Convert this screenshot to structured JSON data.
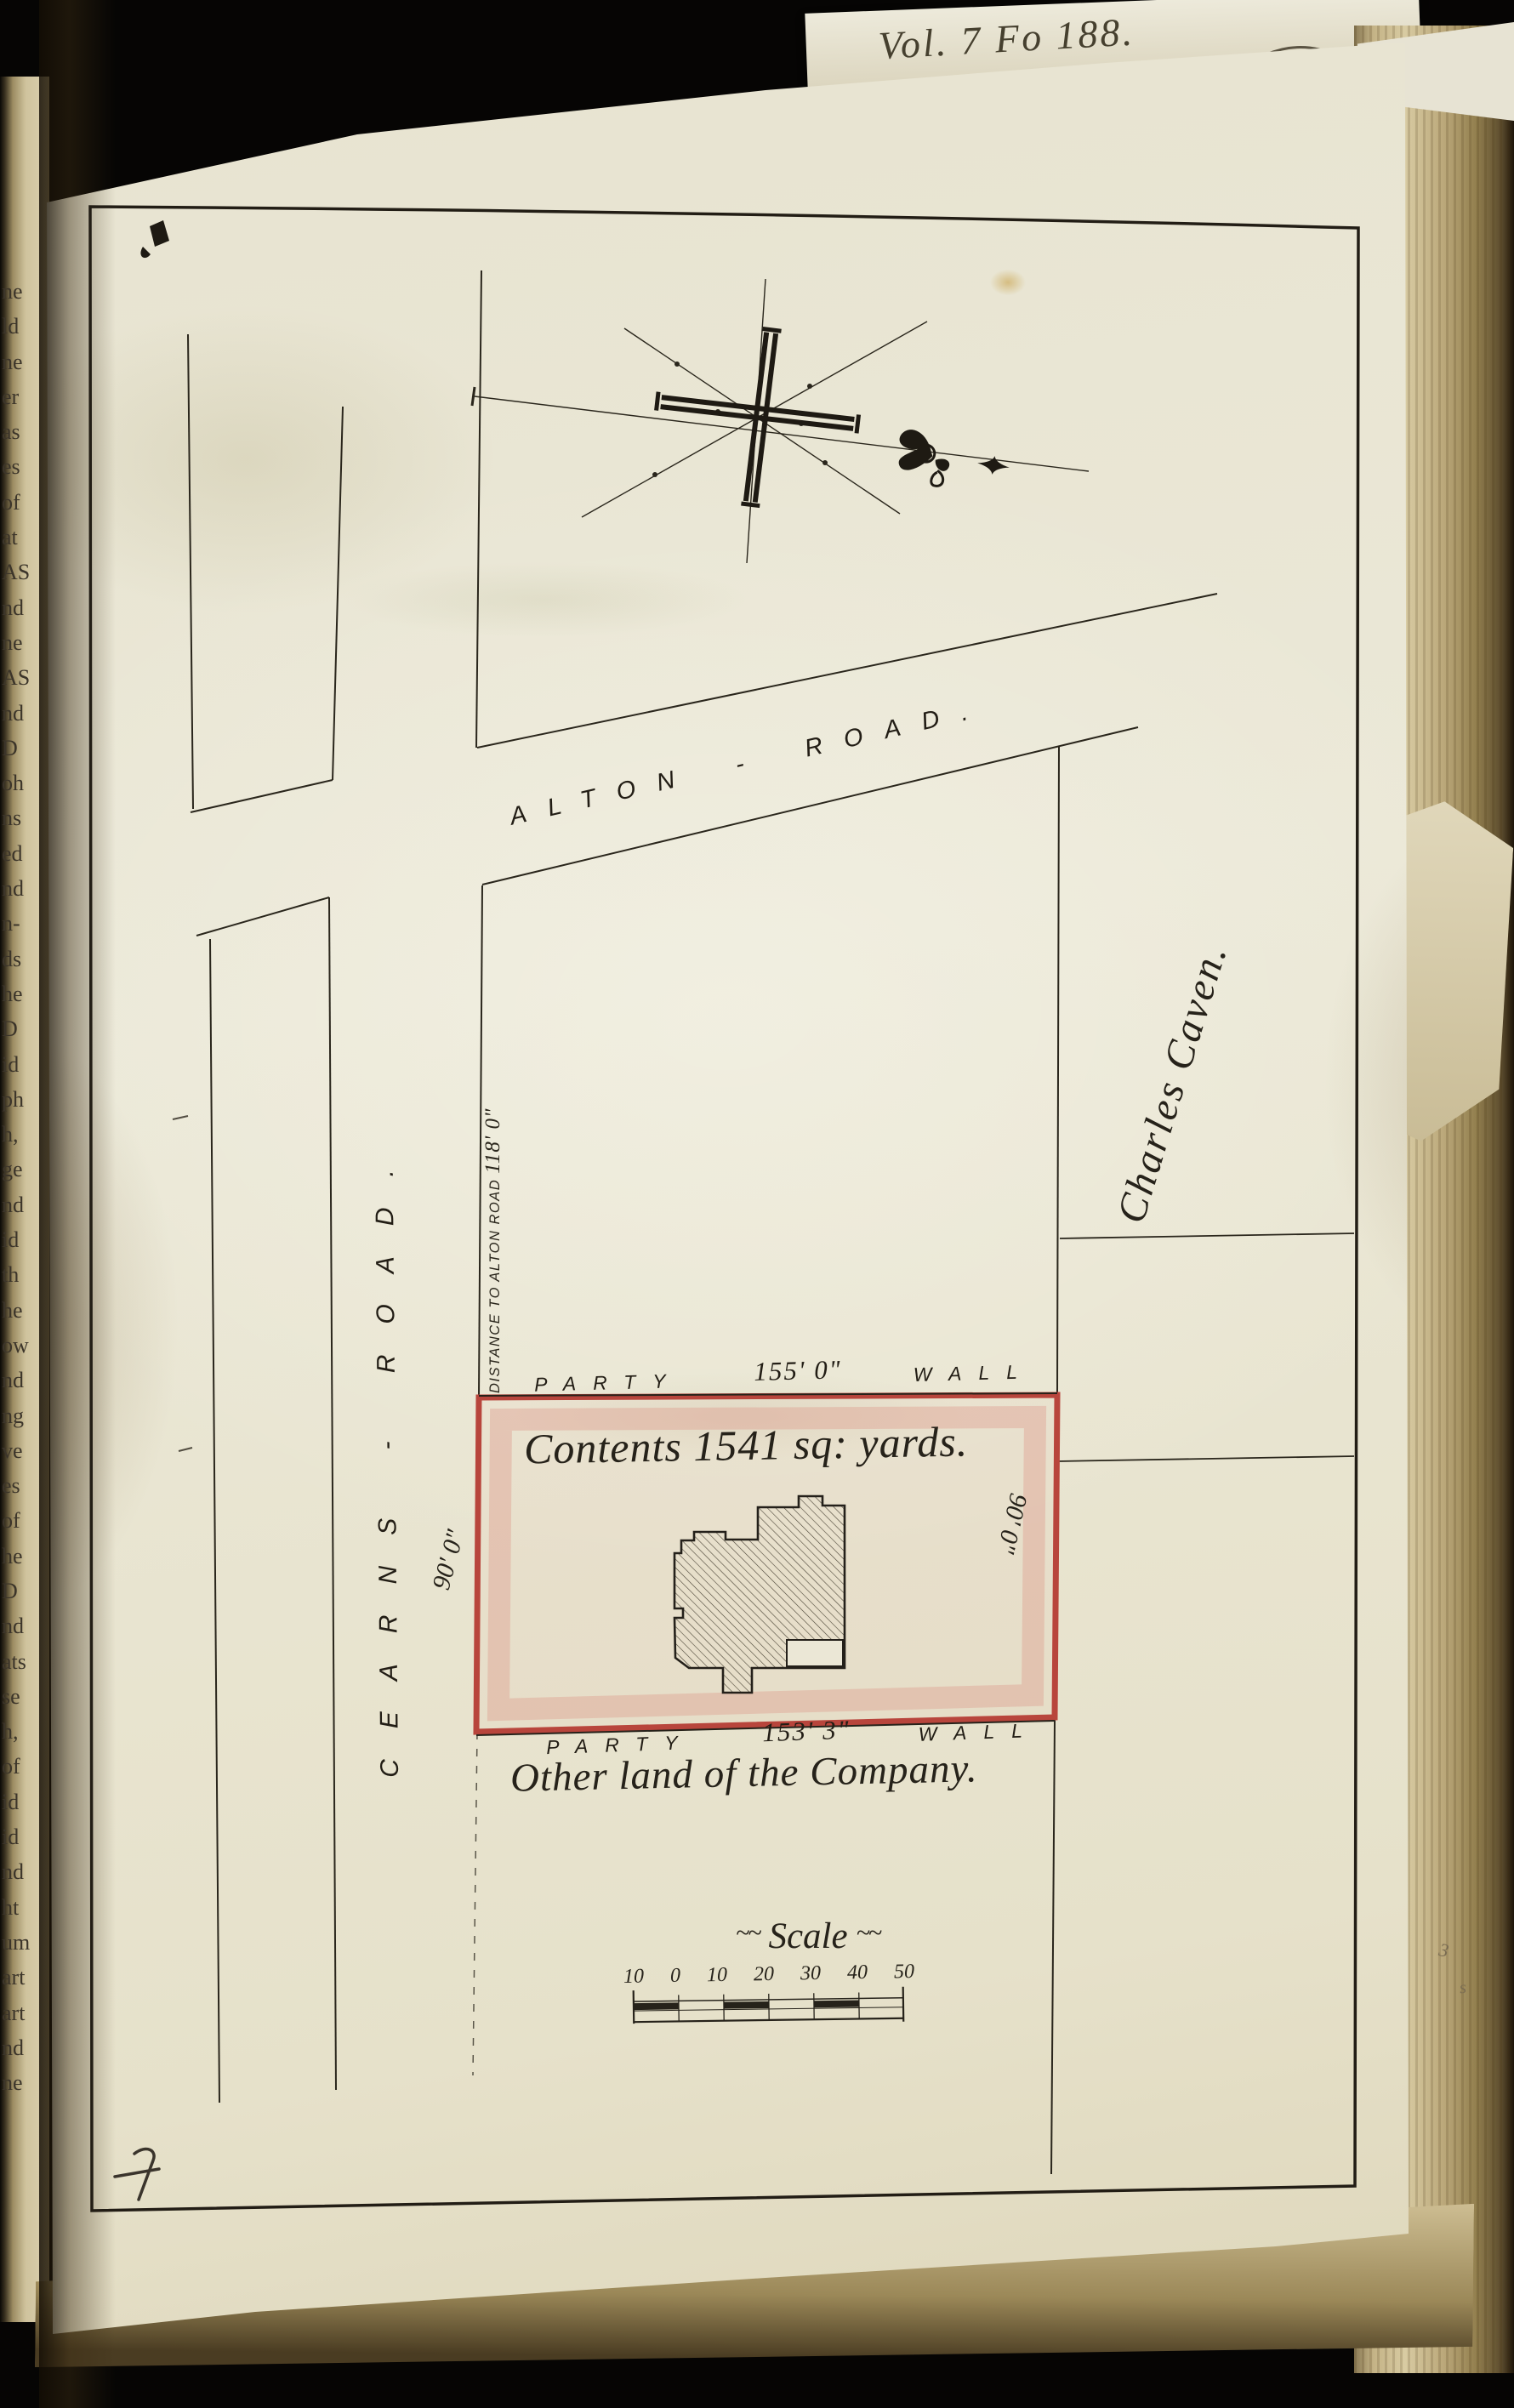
{
  "book": {
    "spine_note": "Vol. 7 Fo 188.",
    "stamp": {
      "arc_text": "RECEIVED",
      "inner_text": "AP"
    },
    "pencil_marks": [
      "3",
      "s"
    ],
    "left_page_fragments": [
      "ne",
      "ld",
      "ne",
      "er",
      "as",
      "es",
      "of",
      "at",
      "AS",
      "nd",
      "ne",
      "AS",
      "nd",
      "D",
      "oh",
      "ns",
      "ed",
      "nd",
      "n-",
      "ds",
      "he",
      "D",
      "id",
      "ph",
      "h,",
      "ge",
      "nd",
      "id",
      "th",
      "he",
      "ow",
      "nd",
      "ng",
      "ve",
      "es",
      "of",
      "he",
      "D",
      "nd",
      "ats",
      "se",
      "h,",
      "of",
      "id",
      "id",
      "nd",
      "ht",
      "um",
      "art",
      "art",
      "nd",
      "ne"
    ]
  },
  "map": {
    "roads": {
      "alton_label": "ALTON - ROAD.",
      "cearns_label": "CEARNS - ROAD."
    },
    "boundary": {
      "distance_label": "DISTANCE TO ALTON ROAD ",
      "distance_value": "118' 0\""
    },
    "parcel": {
      "contents_label": "Contents 1541 sq: yards.",
      "party_top": {
        "left": "PARTY",
        "value": "155' 0\"",
        "right": "WALL"
      },
      "party_bottom": {
        "left": "PARTY",
        "value": "153' 3\"",
        "right": "WALL"
      },
      "side_left": "90' 0\"",
      "side_right": "90' 0\""
    },
    "neighbors": {
      "east_owner": "Charles Caven.",
      "south_note": "Other land of the Company."
    },
    "scale": {
      "flourish_left": "~~",
      "title": "Scale",
      "flourish_right": "~~",
      "ticks": [
        "10",
        "0",
        "10",
        "20",
        "30",
        "40",
        "50"
      ]
    }
  },
  "colors": {
    "parcel_red": "#b8453c",
    "parcel_wash": "#debba9",
    "ink": "#2a261c",
    "paper": "#ebe7d6"
  }
}
